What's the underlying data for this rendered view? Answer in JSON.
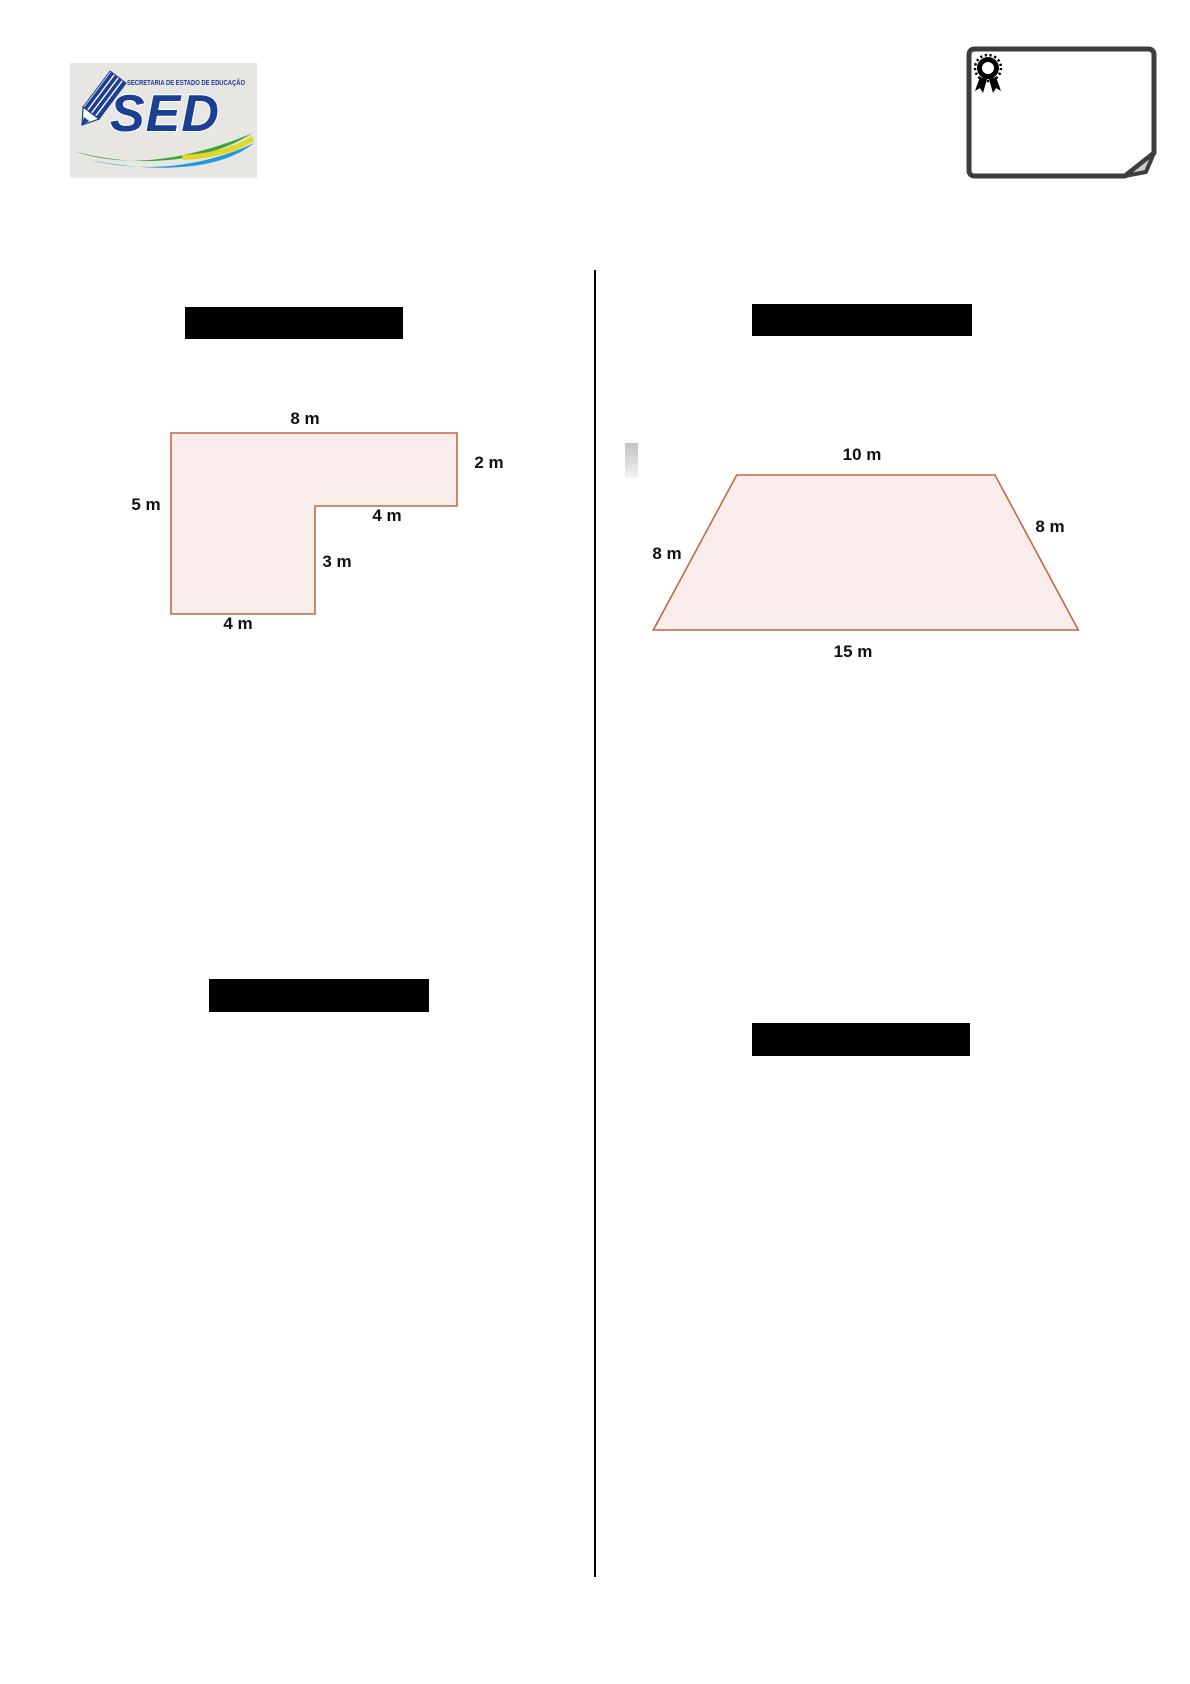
{
  "page": {
    "background": "#ffffff"
  },
  "header": {
    "logo": {
      "acronym": "SED",
      "tagline": "SECRETARIA DE ESTADO DE EDUCAÇÃO",
      "background": "#e8e6e2",
      "blue": "#1c3f94",
      "swoosh_green": "#3fa43c",
      "swoosh_blue": "#1f9cd8"
    },
    "note": {
      "icon": "award-ribbon-icon",
      "border_color": "#3d3d3d",
      "curl_color": "#c9c9c9"
    }
  },
  "divider": {
    "color": "#000000"
  },
  "redacted_bars": {
    "color": "#000000",
    "count": 4
  },
  "figures": {
    "l_shape": {
      "type": "rectilinear-polygon",
      "fill": "#f8edeb",
      "stroke": "#c06a45",
      "labels": {
        "top": "8 m",
        "right": "2 m",
        "left": "5 m",
        "inner_horizontal": "4 m",
        "inner_vertical": "3 m",
        "bottom": "4 m"
      }
    },
    "trapezoid": {
      "type": "trapezoid",
      "fill": "#f8edeb",
      "stroke": "#c06a45",
      "labels": {
        "top": "10 m",
        "right": "8 m",
        "left": "8 m",
        "bottom": "15 m"
      }
    }
  }
}
